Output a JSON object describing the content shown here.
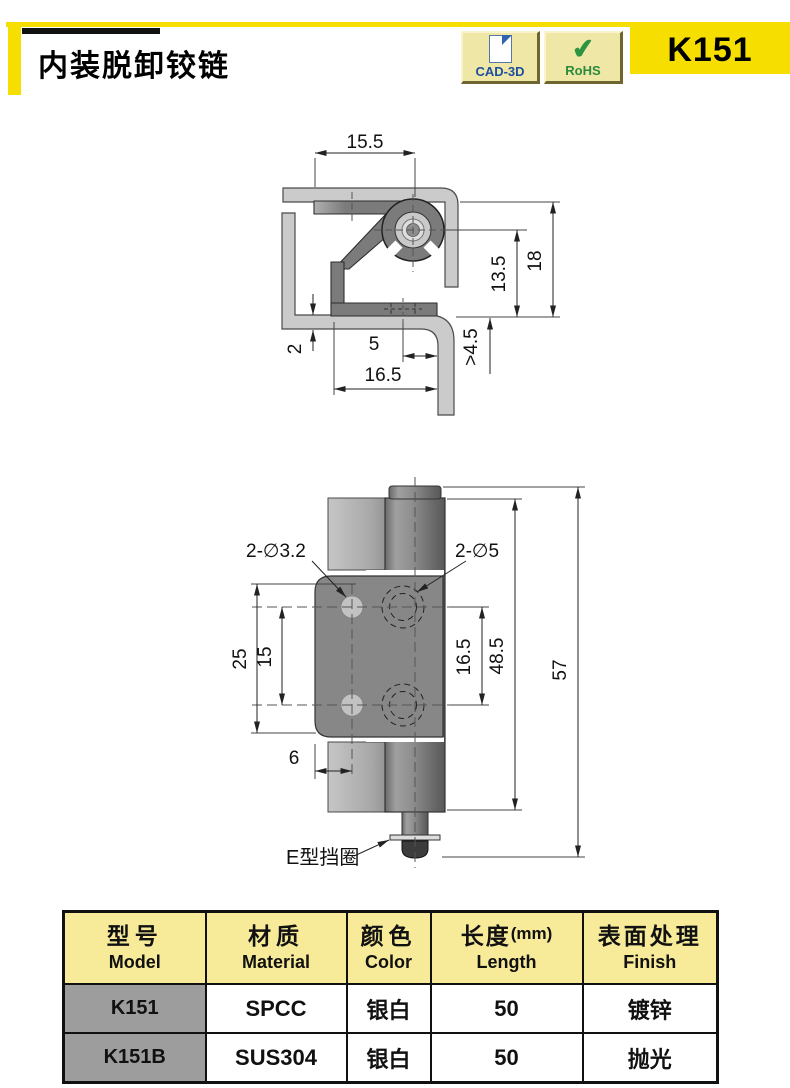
{
  "header": {
    "title": "内装脱卸铰链",
    "part_no": "K151",
    "badges": [
      {
        "label": "CAD-3D"
      },
      {
        "label": "RoHS"
      }
    ],
    "accent_yellow": "#F6DE00"
  },
  "drawing_top": {
    "description": "cross-section of mounted hinge",
    "dims": {
      "width_top": "15.5",
      "pin_height": "13.5",
      "total_height": "18",
      "panel_thickness": "2",
      "edge_offset": "5",
      "min_clearance": ">4.5",
      "total_width": "16.5"
    }
  },
  "drawing_front": {
    "description": "front view of hinge leaf and barrel",
    "dims": {
      "small_holes": "2-∅3.2",
      "large_holes": "2-∅5",
      "outer_spacing": "25",
      "small_hole_spacing": "15",
      "large_hole_spacing": "16.5",
      "leaf_height": "48.5",
      "total_height": "57",
      "hole_edge_offset": "6"
    },
    "labels": {
      "e_ring": "E型挡圈"
    }
  },
  "table": {
    "headers": [
      {
        "zh": "型号",
        "en": "Model"
      },
      {
        "zh": "材质",
        "en": "Material"
      },
      {
        "zh": "颜色",
        "en": "Color"
      },
      {
        "zh": "长度",
        "unit": "(mm)",
        "en": "Length"
      },
      {
        "zh": "表面处理",
        "en": "Finish"
      }
    ],
    "rows": [
      [
        "K151",
        "SPCC",
        "银白",
        "50",
        "镀锌"
      ],
      [
        "K151B",
        "SUS304",
        "银白",
        "50",
        "抛光"
      ]
    ],
    "header_bg": "#F7EA98",
    "model_cell_bg": "#9D9D9D"
  }
}
